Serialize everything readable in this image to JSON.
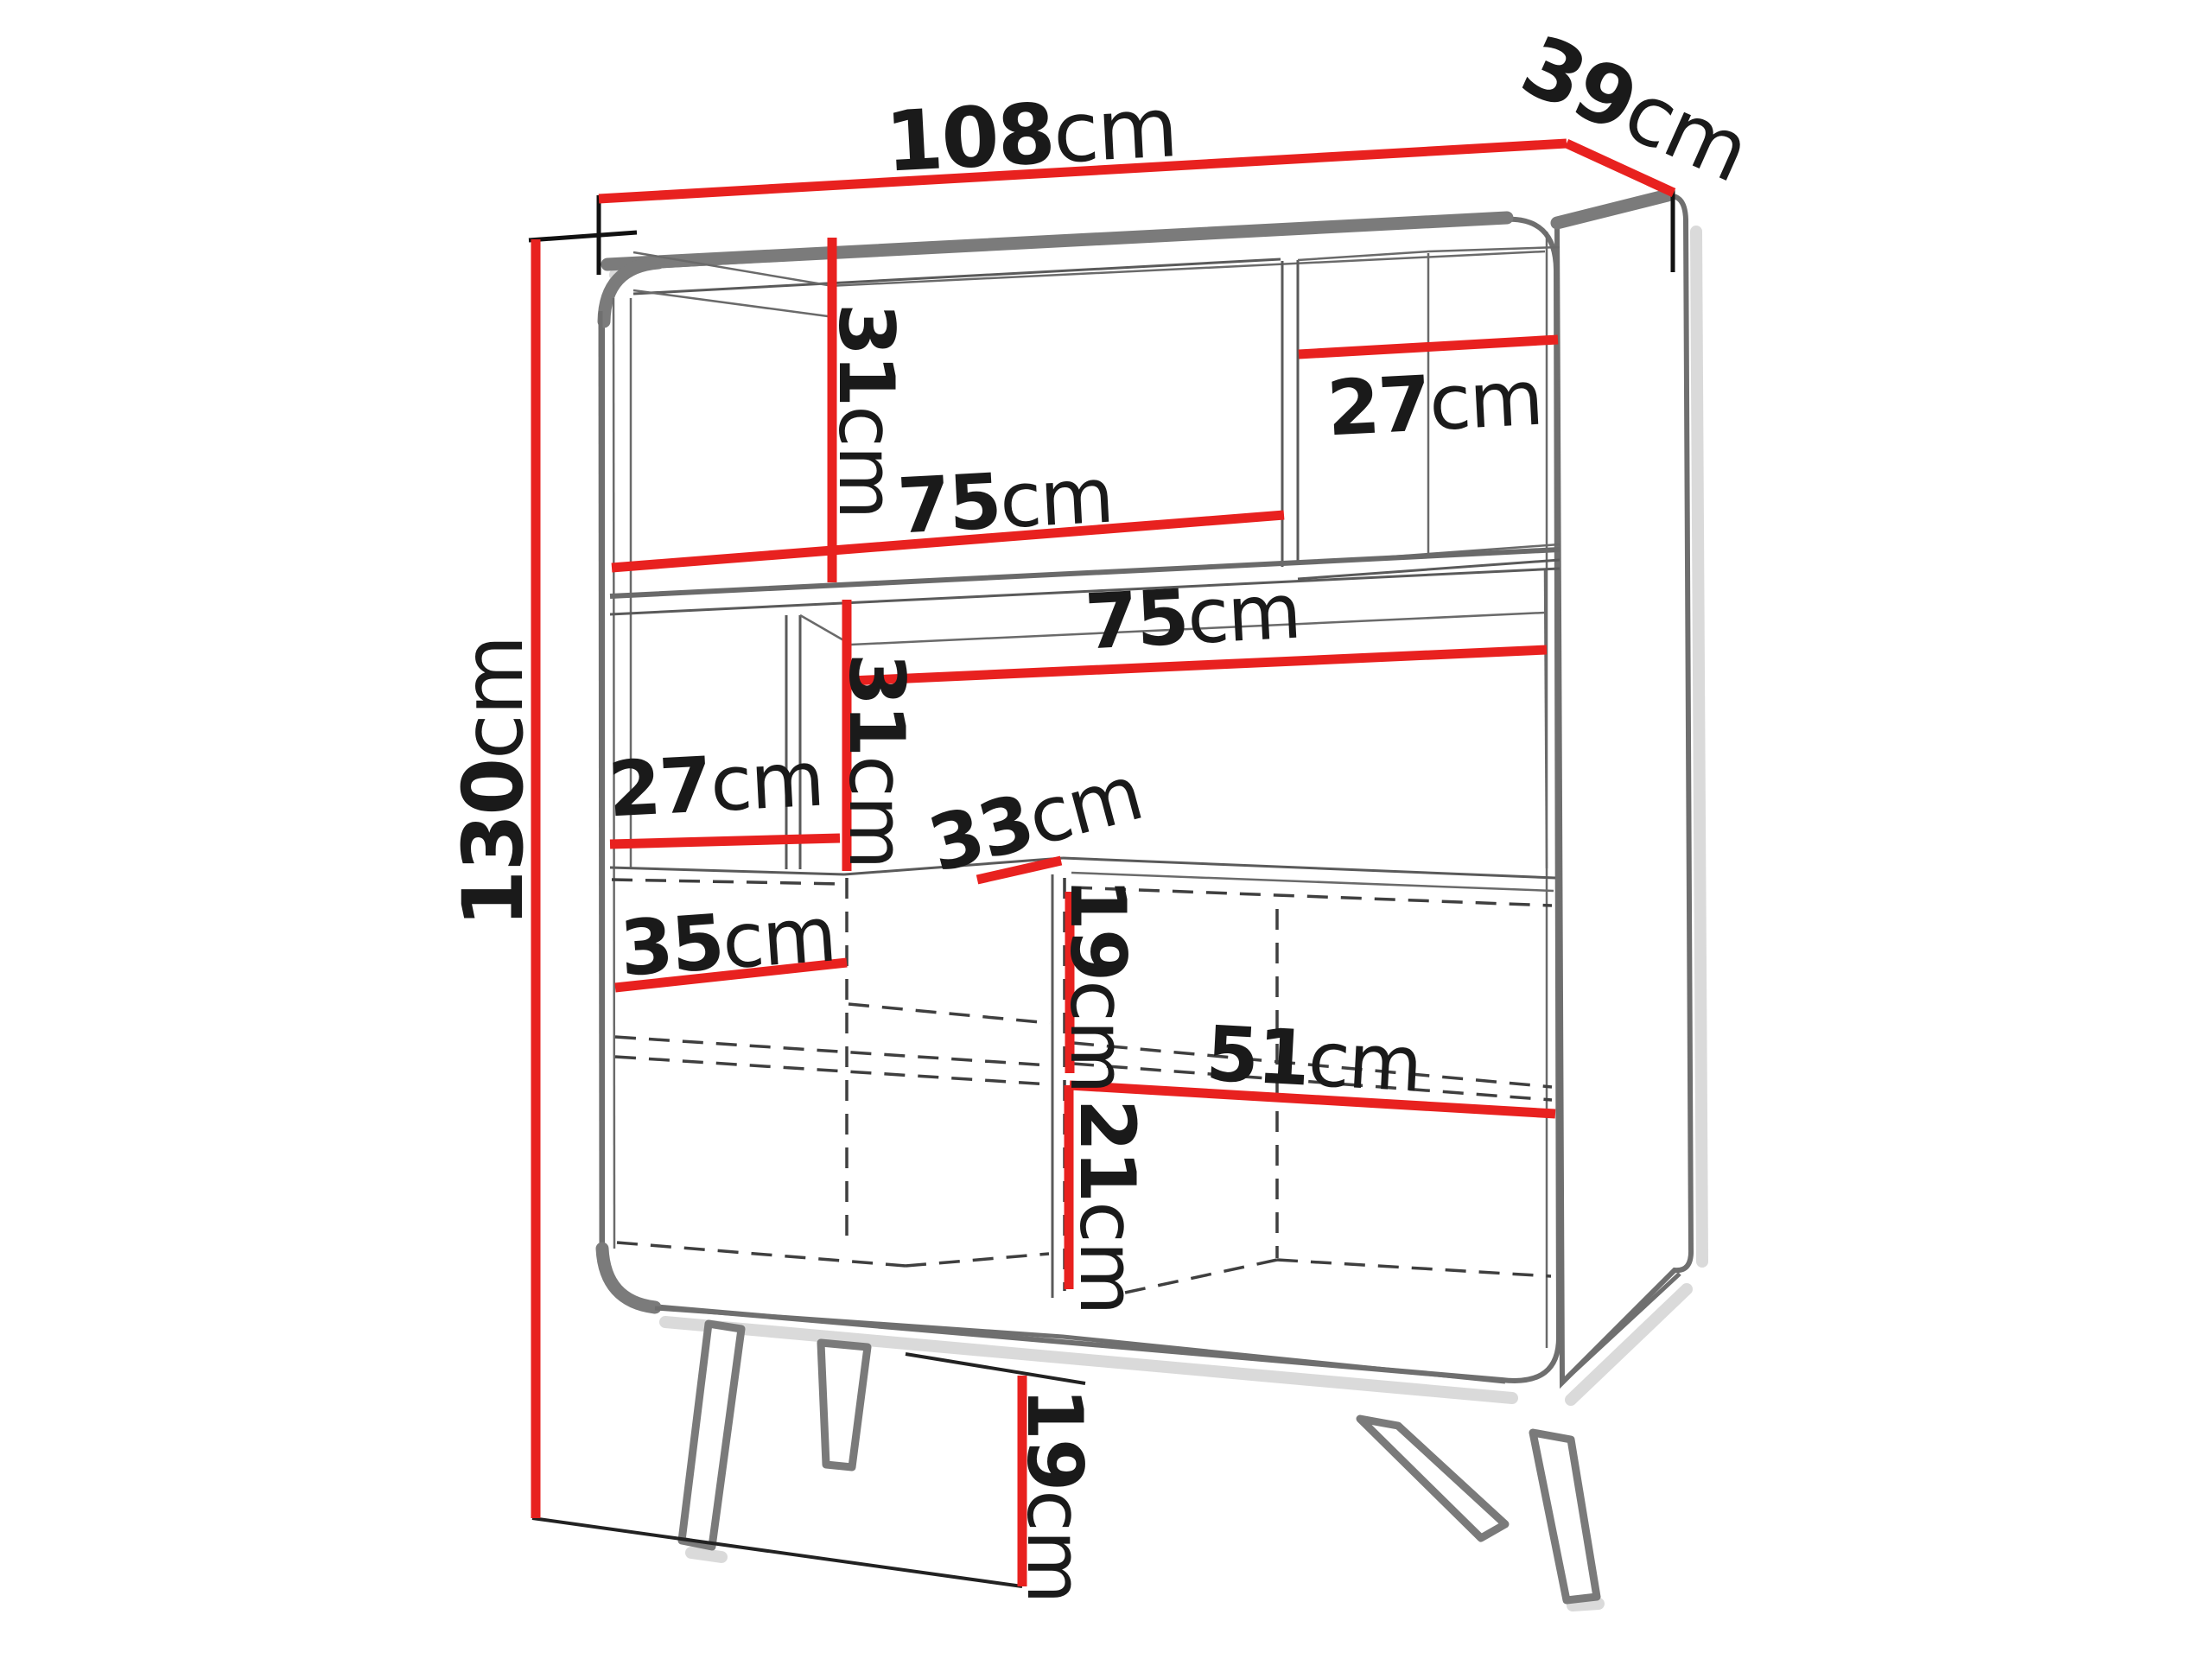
{
  "diagram": {
    "type": "furniture-dimension-diagram",
    "subject": "highboard cabinet perspective line drawing",
    "unit": "cm",
    "accent_color": "#e8211f",
    "line_color": "#6f6f6f",
    "dimensions": {
      "overall_width": {
        "value": "108",
        "unit": "cm"
      },
      "overall_depth": {
        "value": "39",
        "unit": "cm"
      },
      "overall_height": {
        "value": "130",
        "unit": "cm"
      },
      "top_left_compartment_height": {
        "value": "31",
        "unit": "cm"
      },
      "top_left_compartment_width": {
        "value": "75",
        "unit": "cm"
      },
      "top_right_compartment_width": {
        "value": "27",
        "unit": "cm"
      },
      "middle_compartment_width": {
        "value": "75",
        "unit": "cm"
      },
      "middle_left_compartment_width": {
        "value": "27",
        "unit": "cm"
      },
      "middle_compartment_height": {
        "value": "31",
        "unit": "cm"
      },
      "counter_depth": {
        "value": "33",
        "unit": "cm"
      },
      "lower_left_compartment_width": {
        "value": "35",
        "unit": "cm"
      },
      "lower_right_upper_height": {
        "value": "19",
        "unit": "cm"
      },
      "lower_right_compartment_width": {
        "value": "51",
        "unit": "cm"
      },
      "lower_right_lower_height": {
        "value": "21",
        "unit": "cm"
      },
      "leg_height": {
        "value": "19",
        "unit": "cm"
      }
    }
  }
}
